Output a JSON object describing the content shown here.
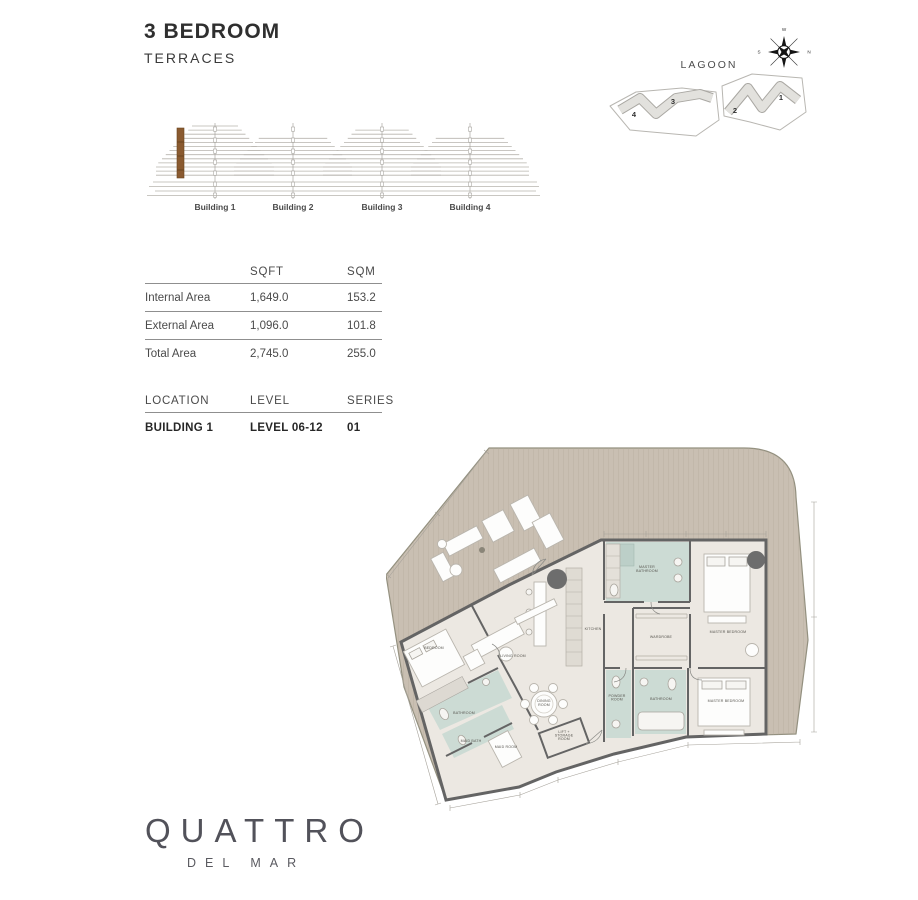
{
  "header": {
    "title": "3 BEDROOM",
    "subtitle": "TERRACES"
  },
  "site_plan": {
    "area_label": "LAGOON",
    "compass": {
      "top": "W",
      "right": "N",
      "bottom": "E",
      "left": "S"
    },
    "building_numbers": [
      "4",
      "3",
      "2",
      "1"
    ]
  },
  "elevation": {
    "building_labels": [
      "Building 1",
      "Building 2",
      "Building 3",
      "Building 4"
    ],
    "highlight_color": "#8a5a30"
  },
  "area_table": {
    "col_headers": [
      "SQFT",
      "SQM"
    ],
    "rows": [
      {
        "label": "Internal Area",
        "sqft": "1,649.0",
        "sqm": "153.2"
      },
      {
        "label": "External Area",
        "sqft": "1,096.0",
        "sqm": "101.8"
      },
      {
        "label": "Total Area",
        "sqft": "2,745.0",
        "sqm": "255.0"
      }
    ]
  },
  "location_table": {
    "headers": [
      "LOCATION",
      "LEVEL",
      "SERIES"
    ],
    "values": {
      "location": "BUILDING 1",
      "level": "LEVEL 06-12",
      "series": "01"
    }
  },
  "floor_plan": {
    "colors": {
      "terrace": "#c9bfb2",
      "floor": "#ece8e2",
      "wall": "#646464",
      "bathroom": "#ccdbd4",
      "accent_circle": "#6d6d6d"
    },
    "labels": [
      {
        "x": 207,
        "y": 188,
        "lines": [
          "KITCHEN"
        ]
      },
      {
        "x": 261,
        "y": 126,
        "lines": [
          "MASTER",
          "BATHROOM"
        ]
      },
      {
        "x": 275,
        "y": 196,
        "lines": [
          "WARDROBE"
        ]
      },
      {
        "x": 342,
        "y": 191,
        "lines": [
          "MASTER BEDROOM"
        ]
      },
      {
        "x": 127,
        "y": 215,
        "lines": [
          "LIVING ROOM"
        ]
      },
      {
        "x": 158,
        "y": 260,
        "lines": [
          "DINING",
          "ROOM"
        ]
      },
      {
        "x": 48,
        "y": 207,
        "lines": [
          "BEDROOM"
        ]
      },
      {
        "x": 78,
        "y": 272,
        "lines": [
          "BATHROOM"
        ]
      },
      {
        "x": 120,
        "y": 306,
        "lines": [
          "MAID ROOM"
        ]
      },
      {
        "x": 85,
        "y": 300,
        "lines": [
          "MAID BATH"
        ],
        "fs": 3
      },
      {
        "x": 178,
        "y": 291,
        "lines": [
          "LIFT +",
          "STORAGE",
          "ROOM"
        ],
        "fs": 3
      },
      {
        "x": 231,
        "y": 255,
        "lines": [
          "POWDER",
          "ROOM"
        ],
        "fs": 3
      },
      {
        "x": 275,
        "y": 258,
        "lines": [
          "BATHROOM"
        ],
        "fs": 3.2
      },
      {
        "x": 340,
        "y": 260,
        "lines": [
          "MASTER BEDROOM"
        ]
      }
    ]
  },
  "logo": {
    "brand": "QUATTRO",
    "sub": "DEL MAR"
  }
}
